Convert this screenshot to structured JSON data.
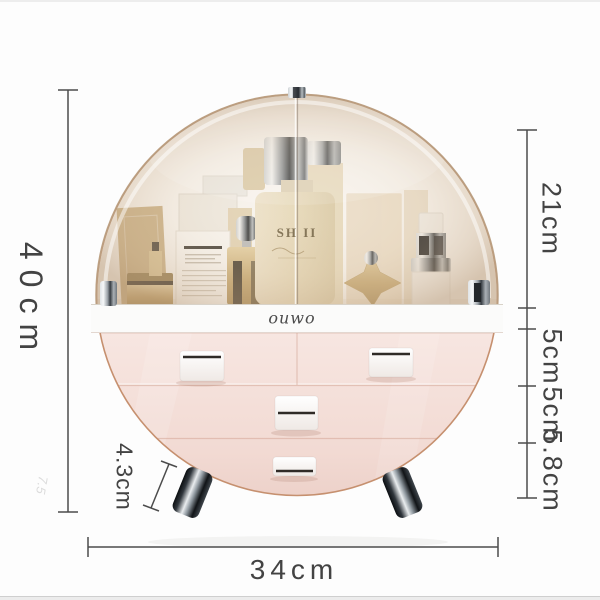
{
  "page": {
    "background_color": "#fdfdfd",
    "edge_strip_color": "#ededed"
  },
  "dimension_labels": {
    "height": "40cm",
    "width": "34cm",
    "dome_height": "21cm",
    "drawer1_height": "5cm",
    "drawer2_height": "5cm",
    "drawer3_height": "5.8cm",
    "leg_height": "4.3cm"
  },
  "product": {
    "brand_logo": "ouwo",
    "bottle_label": "SH II",
    "colors": {
      "dome_tint": "#d8c3a8",
      "drawer_pink": "#f4e0da",
      "outline_rose": "#c6906f",
      "band_white": "#fbfbfa",
      "chrome_dark": "#23282d",
      "gold": "#c9ad7c"
    }
  },
  "watermark": "7.5"
}
